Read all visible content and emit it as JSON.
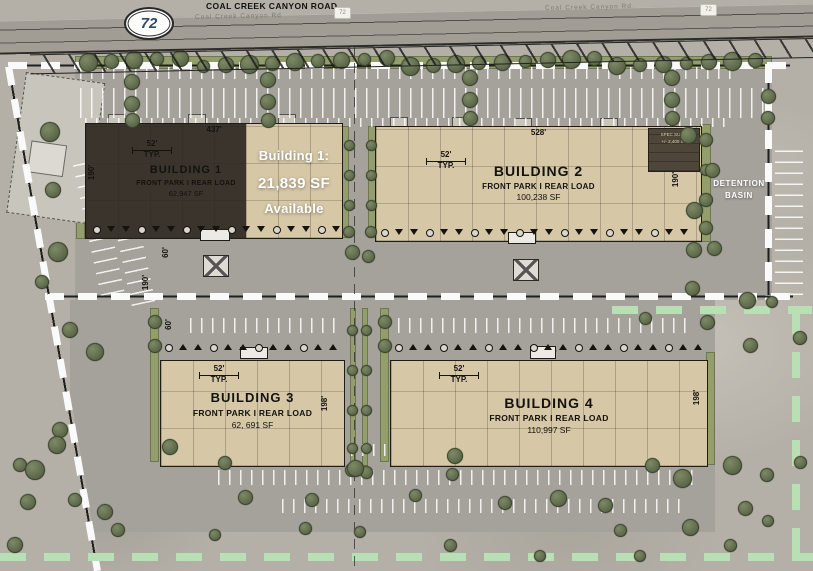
{
  "road": {
    "name": "COAL CREEK CANYON ROAD",
    "shield": "72",
    "marker": "72",
    "pavement_label": "Coal Creek Canyon Rd"
  },
  "labels": {
    "detention_line1": "DETENTION",
    "detention_line2": "BASIN"
  },
  "court_dims": {
    "north_court": "60'",
    "drive": "190'",
    "south_court": "60'"
  },
  "buildings": [
    {
      "name": "BUILDING 1",
      "loadtype": "FRONT PARK I REAR LOAD",
      "area": "62,947 SF",
      "width": "437'",
      "bay": "52'",
      "typ": "TYP.",
      "depth": "190'",
      "avail1": "Building 1:",
      "avail2": "21,839 SF",
      "avail3": "Available"
    },
    {
      "name": "BUILDING 2",
      "loadtype": "FRONT PARK I REAR LOAD",
      "area": "100,238 SF",
      "width": "528'",
      "bay": "52'",
      "typ": "TYP.",
      "depth": "190'",
      "spec1": "SPEC SUITE",
      "spec2": "+/- 2,400 SF"
    },
    {
      "name": "BUILDING 3",
      "loadtype": "FRONT PARK I REAR LOAD",
      "area": "62, 691 SF",
      "width": "317'",
      "bay": "52'",
      "typ": "TYP.",
      "depth": "198'"
    },
    {
      "name": "BUILDING 4",
      "loadtype": "FRONT PARK I REAR LOAD",
      "area": "110,997 SF",
      "width": "561'",
      "bay": "52'",
      "typ": "TYP.",
      "depth": "198'"
    }
  ],
  "colors": {
    "building_tan": "#d6c8a7",
    "building_dark": "#3a342c",
    "asphalt": "#a5a29b",
    "ground": "#b4b0a7",
    "landscape": "#939e6c",
    "tree": "#5c684a",
    "green_dash": "#b8e0b4",
    "shield_text": "#2d4a66"
  }
}
